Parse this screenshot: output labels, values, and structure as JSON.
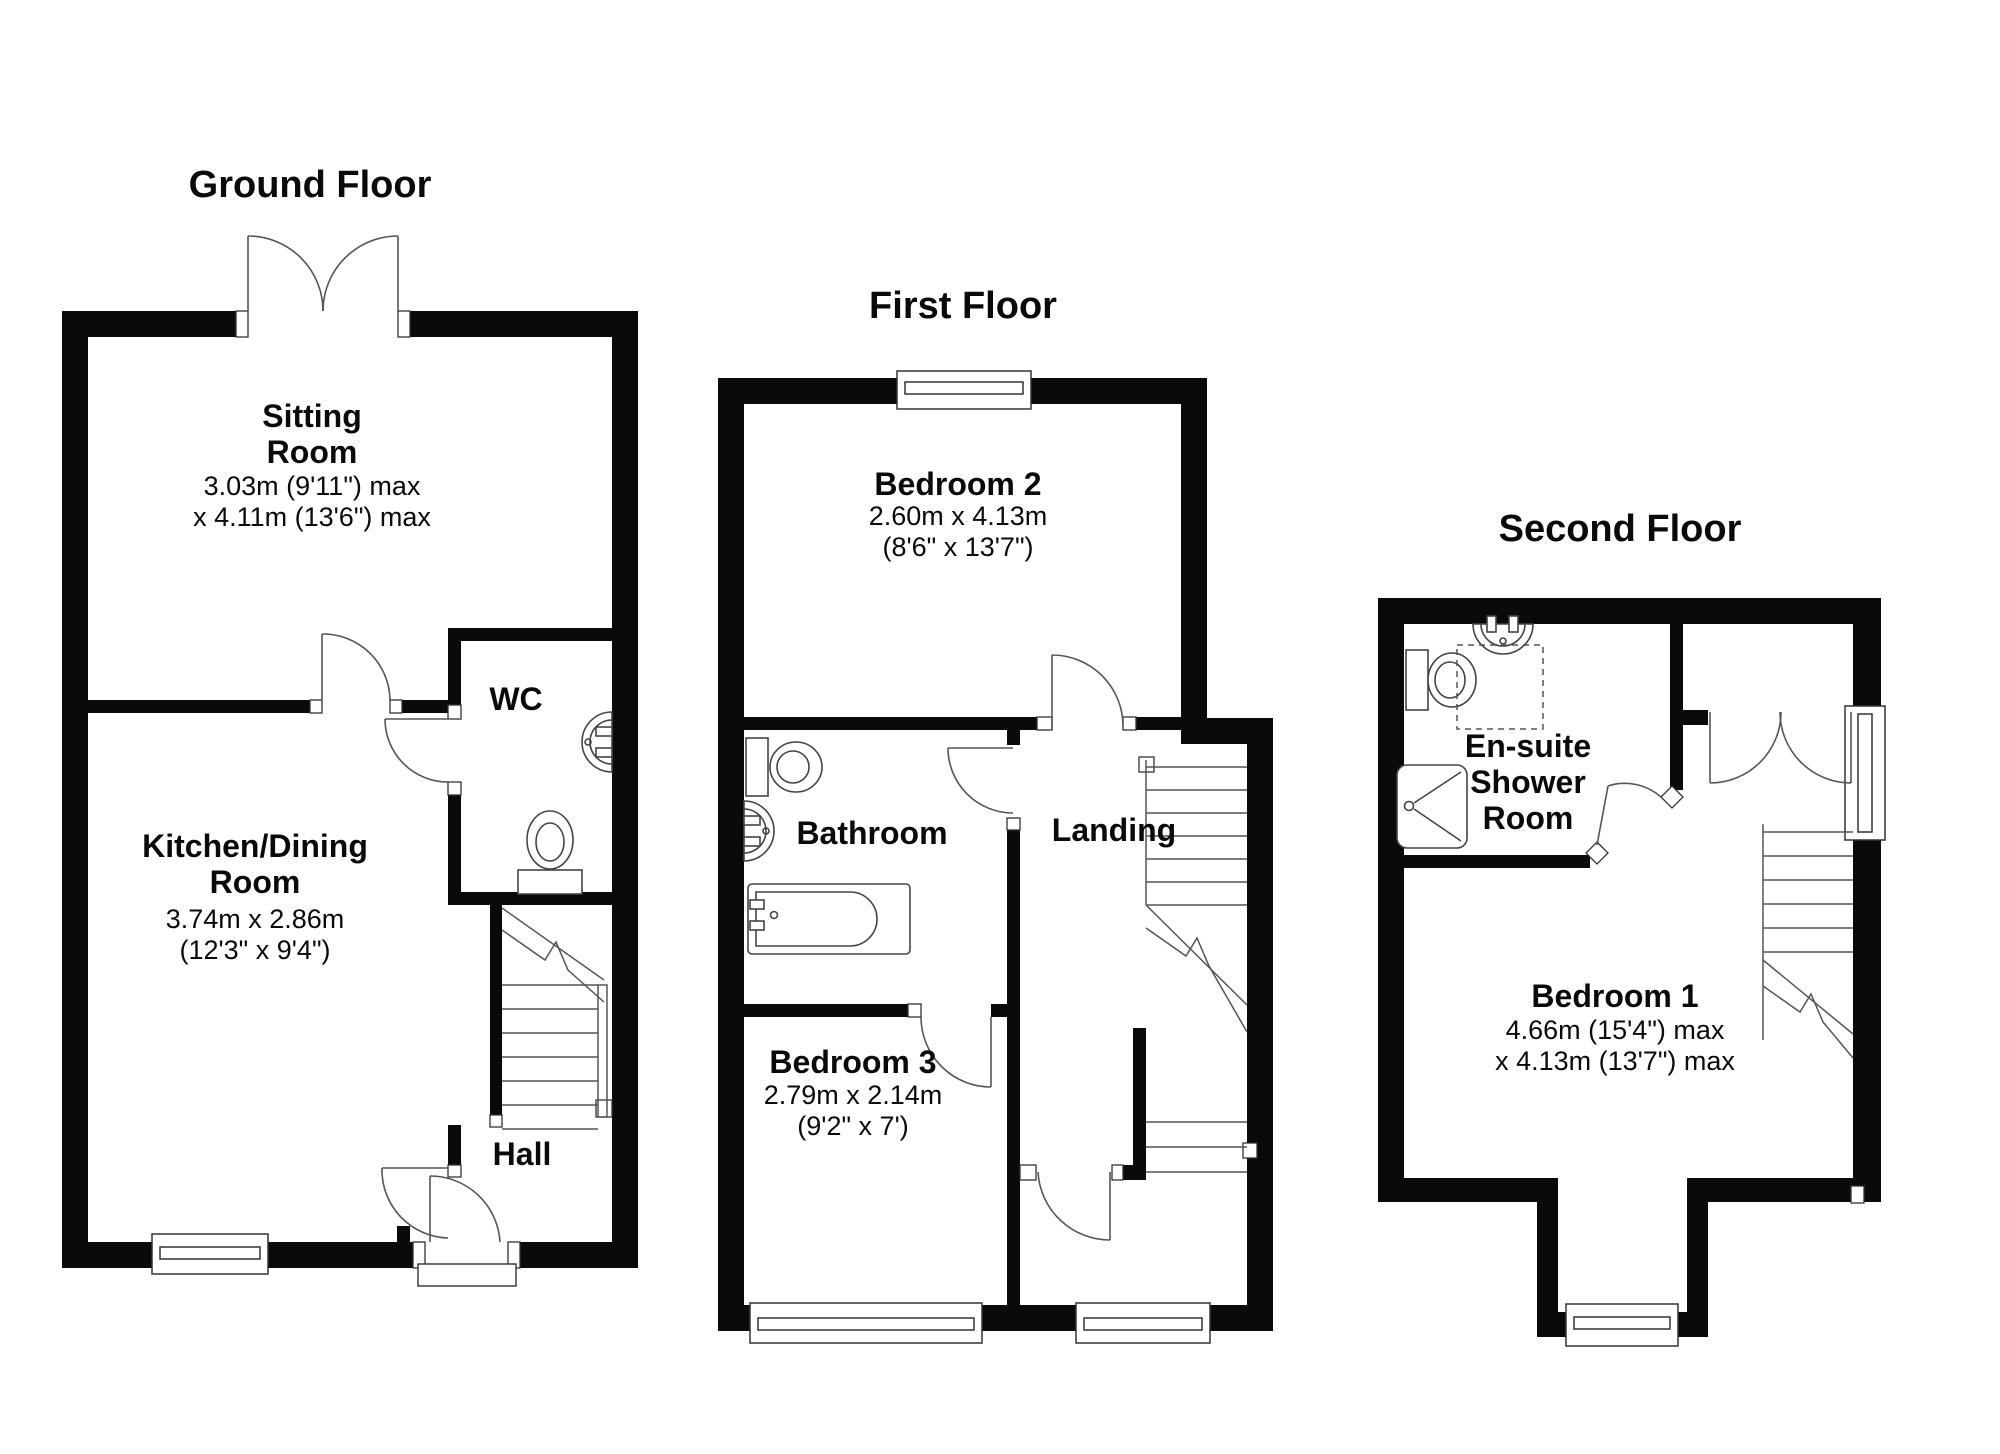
{
  "colors": {
    "wall": "#0a0a0a",
    "background": "#ffffff",
    "fixture_line": "#444444",
    "door_line": "#555555"
  },
  "floors": {
    "ground": {
      "title": "Ground Floor",
      "rooms": {
        "sitting": {
          "name": "Sitting\nRoom",
          "dims": "3.03m (9'11\") max\nx 4.11m (13'6\") max"
        },
        "kitchen": {
          "name": "Kitchen/Dining\nRoom",
          "dims": "3.74m x 2.86m\n(12'3\" x 9'4\")"
        },
        "wc": {
          "name": "WC"
        },
        "hall": {
          "name": "Hall"
        }
      }
    },
    "first": {
      "title": "First Floor",
      "rooms": {
        "bedroom2": {
          "name": "Bedroom 2",
          "dims": "2.60m x 4.13m\n(8'6\" x 13'7\")"
        },
        "bathroom": {
          "name": "Bathroom"
        },
        "landing": {
          "name": "Landing"
        },
        "bedroom3": {
          "name": "Bedroom 3",
          "dims": "2.79m x 2.14m\n(9'2\" x 7')"
        }
      }
    },
    "second": {
      "title": "Second Floor",
      "rooms": {
        "ensuite": {
          "name": "En-suite\nShower\nRoom"
        },
        "bedroom1": {
          "name": "Bedroom 1",
          "dims": "4.66m (15'4\") max\nx 4.13m (13'7\") max"
        }
      }
    }
  }
}
